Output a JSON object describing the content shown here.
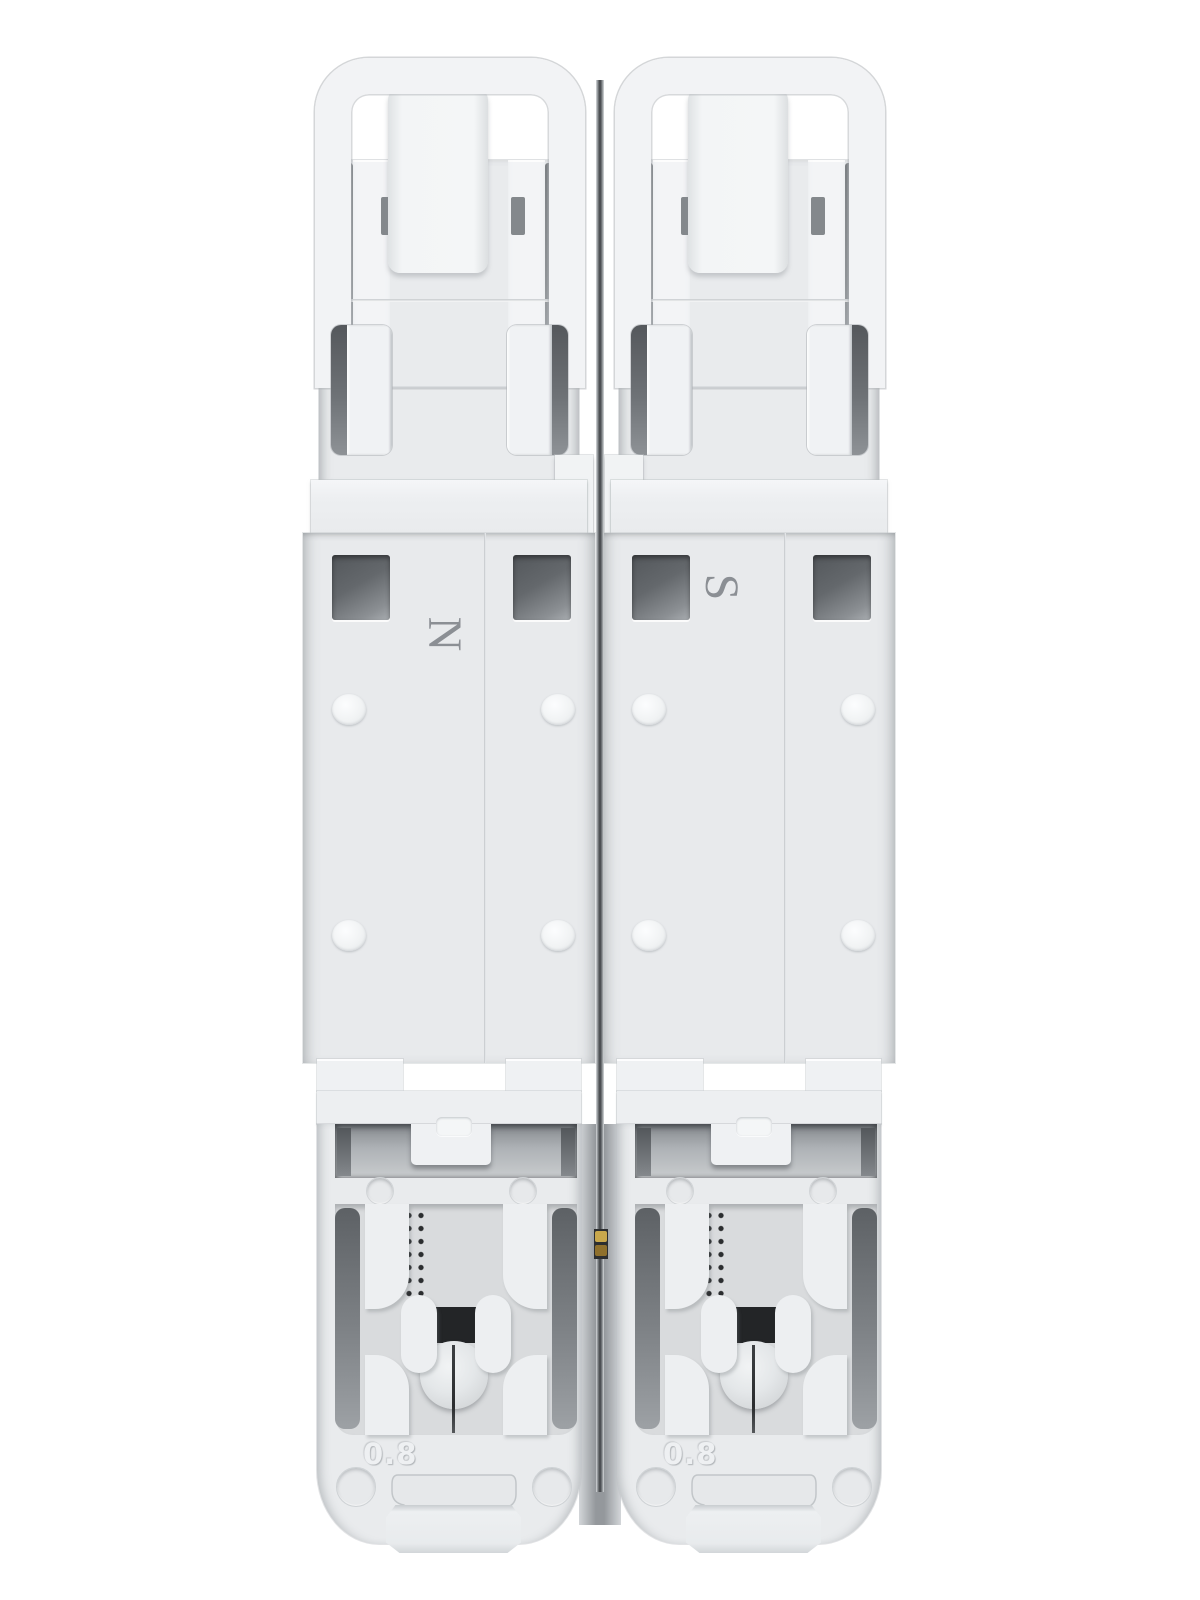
{
  "scene": {
    "type": "product-photo",
    "subject": "Rear view of a two-pole DIN-rail miniature circuit breaker, light gray plastic housing",
    "background_color": "#ffffff"
  },
  "modules": [
    {
      "pole_label": "N",
      "gauge_label": "0.8"
    },
    {
      "pole_label": "S",
      "gauge_label": "0.8"
    }
  ],
  "colors": {
    "housing": "#e9ebed",
    "housing_bright": "#f2f4f6",
    "recess_floor": "#d9dbdd",
    "slot_dark": "#5a5e62",
    "window_dark": "#53575b",
    "marking_gray": "#8b8f94",
    "embossed_text": "#eef0f2",
    "dot_matrix": "#2b2d2f",
    "brass_pin": "#c9a84c"
  }
}
